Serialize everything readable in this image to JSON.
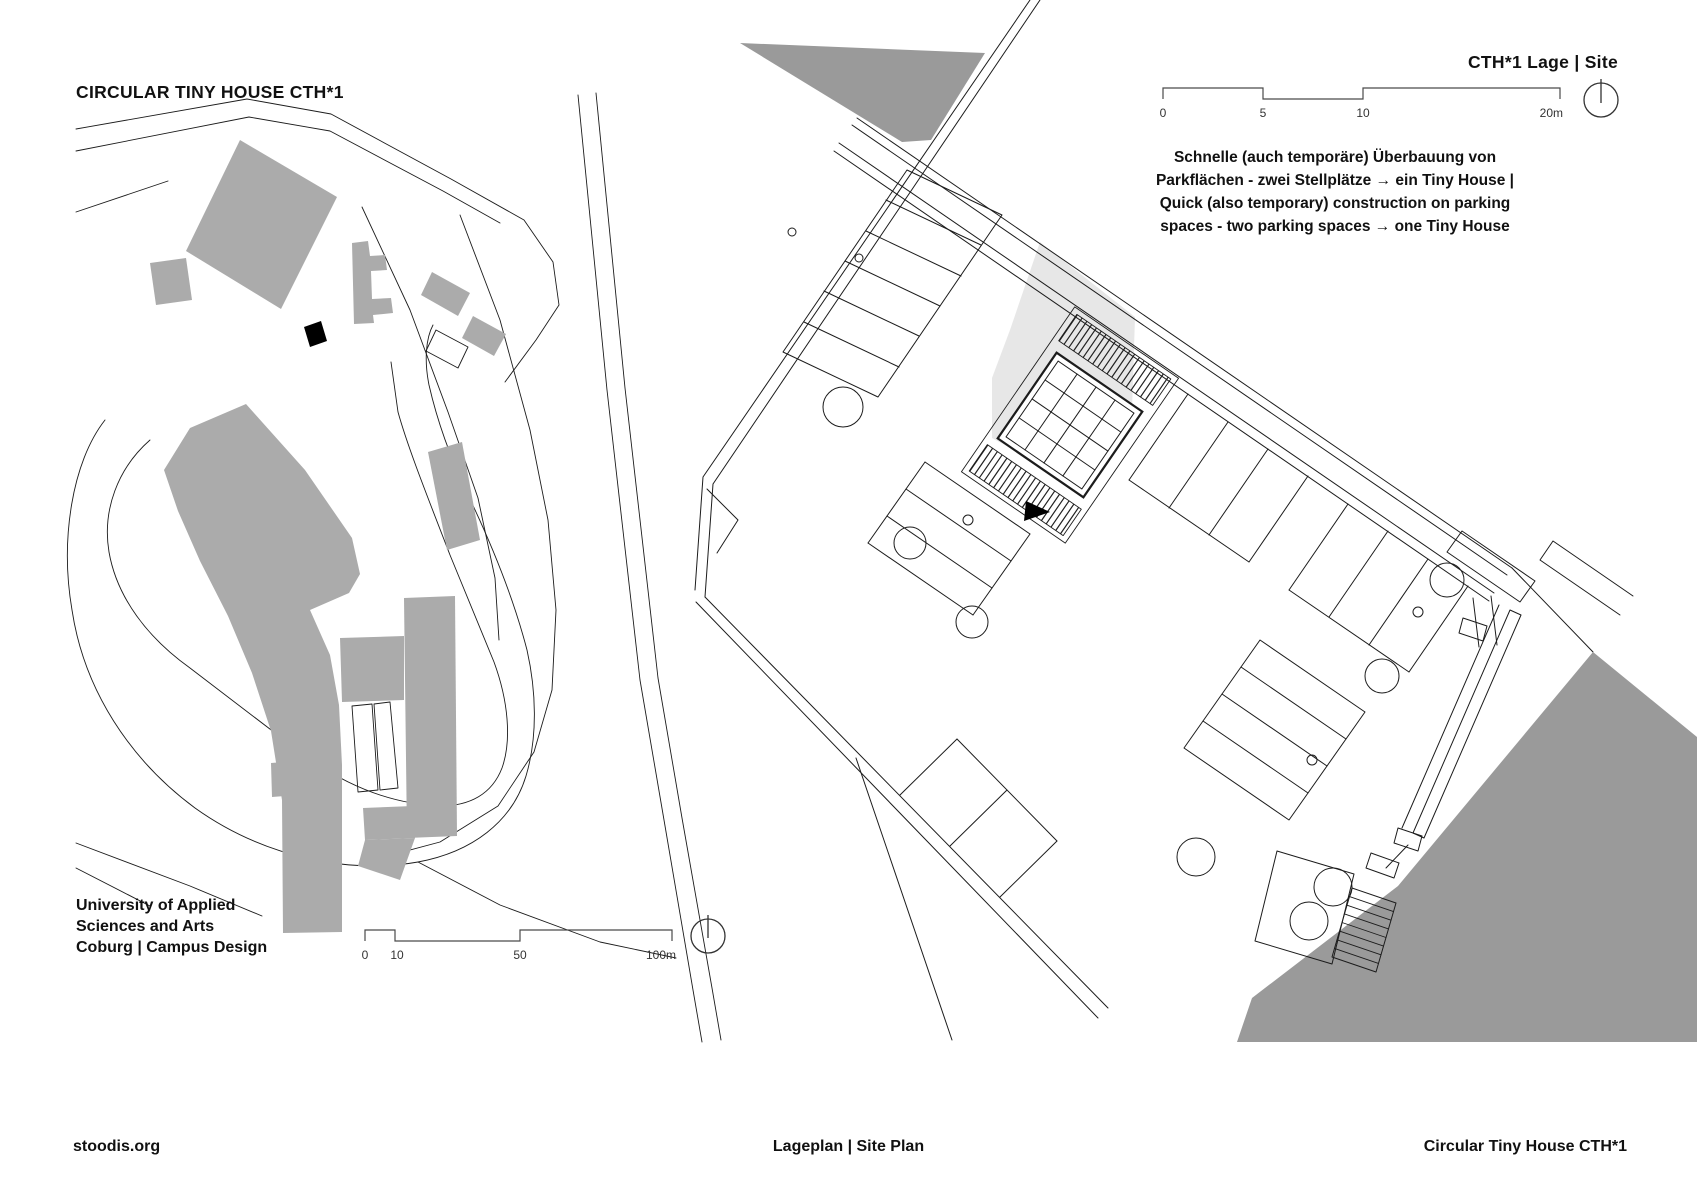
{
  "header": {
    "left_title": "CIRCULAR TINY HOUSE CTH*1",
    "right_title": "CTH*1 Lage | Site"
  },
  "annotation": {
    "lines": [
      "Schnelle (auch temporäre) Überbauung von",
      "Parkflächen - zwei Stellplätze → ein Tiny House |",
      "Quick (also temporary) construction on parking",
      "spaces - two parking spaces → one Tiny House"
    ]
  },
  "campus": {
    "caption_lines": [
      "University of Applied",
      "Sciences and Arts",
      "Coburg | Campus Design"
    ],
    "scale_labels": [
      "0",
      "10",
      "50",
      "100m"
    ]
  },
  "site": {
    "scale_labels": [
      "0",
      "5",
      "10",
      "20m"
    ]
  },
  "footer": {
    "left": "stoodis.org",
    "center": "Lageplan | Site Plan",
    "right": "Circular Tiny House CTH*1"
  },
  "colors": {
    "building_gray": "#ababab",
    "dark_building_gray": "#9a9a9a",
    "highlight_gray": "#e7e7e7",
    "line_color": "#1c1c1c",
    "marker_black": "#000000"
  }
}
